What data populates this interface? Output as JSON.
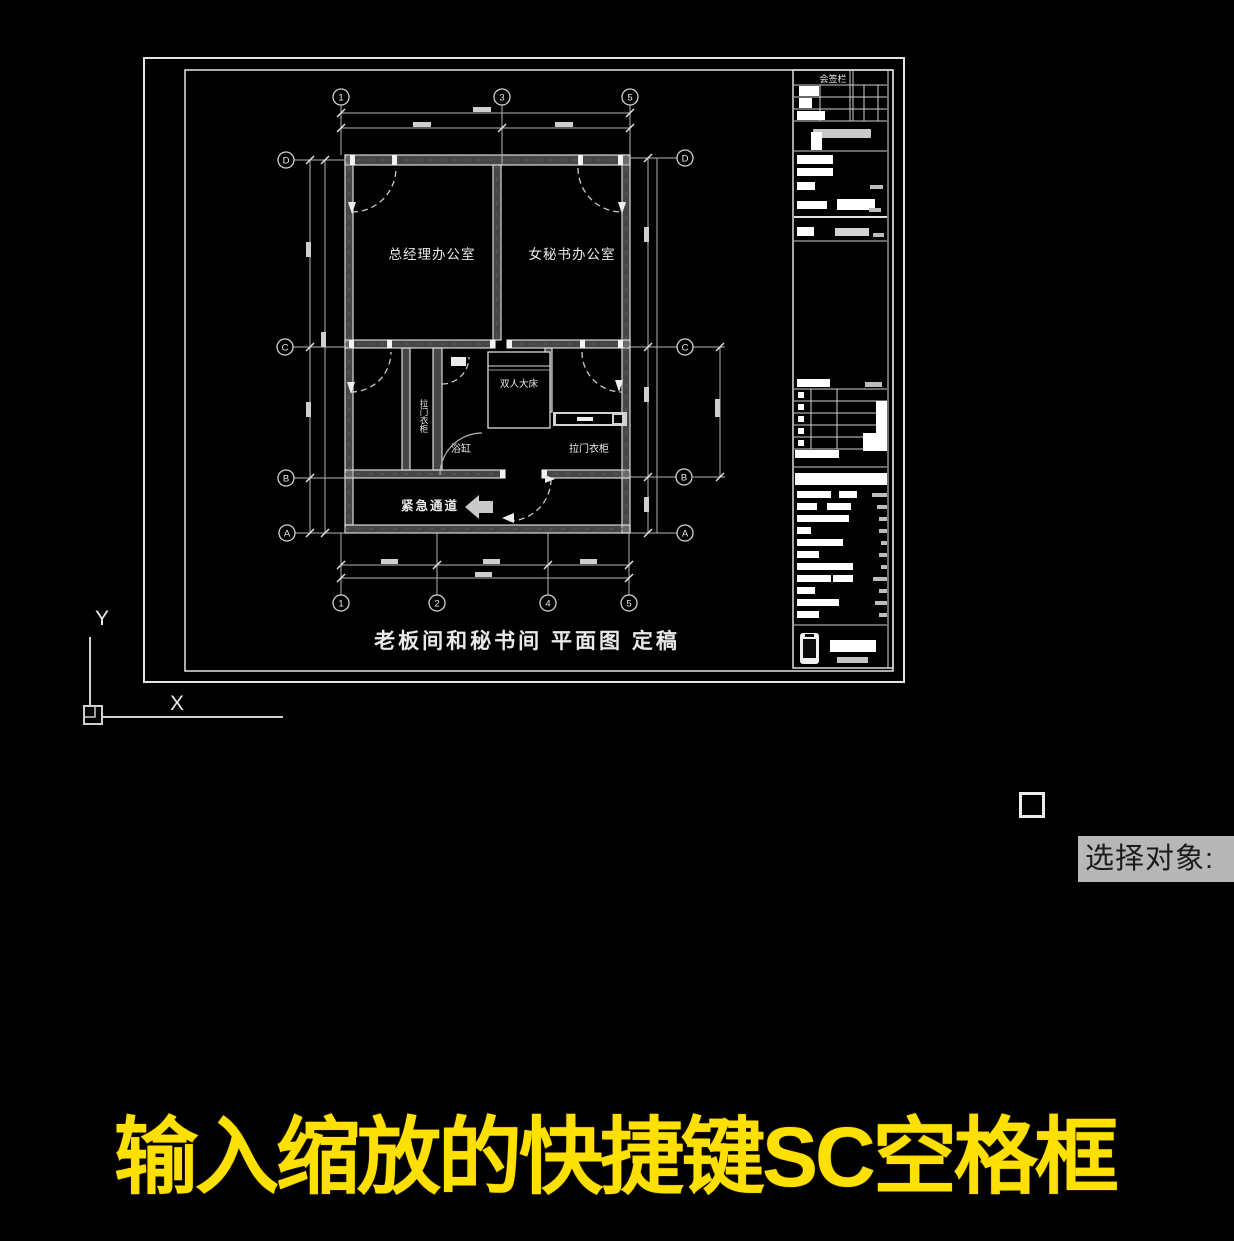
{
  "app": {
    "type": "cad-viewport"
  },
  "plan": {
    "title": "老板间和秘书间 平面图 定稿",
    "rooms": {
      "gm_office": "总经理办公室",
      "secretary_office": "女秘书办公室",
      "double_bed": "双人大床",
      "bathtub": "浴缸",
      "wardrobe_side": "拉门衣柜",
      "wardrobe_right": "拉门衣柜",
      "emergency_passage": "紧急通道"
    },
    "grid_bubbles": {
      "top": [
        "1",
        "3",
        "5"
      ],
      "bottom": [
        "1",
        "2",
        "4",
        "5"
      ],
      "left": [
        "D",
        "C",
        "B",
        "A"
      ],
      "right": [
        "D",
        "C",
        "B",
        "A"
      ]
    },
    "titleblock": {
      "signature_header": "会签栏"
    }
  },
  "ucs": {
    "x": "X",
    "y": "Y"
  },
  "prompt": {
    "text": "选择对象:"
  },
  "caption": {
    "text": "输入缩放的快捷键SC空格框"
  },
  "colors": {
    "background": "#000000",
    "line": "#d9d9d9",
    "caption": "#ffe000",
    "prompt_bg": "#b7b7b7",
    "prompt_text": "#1c1c1c"
  }
}
